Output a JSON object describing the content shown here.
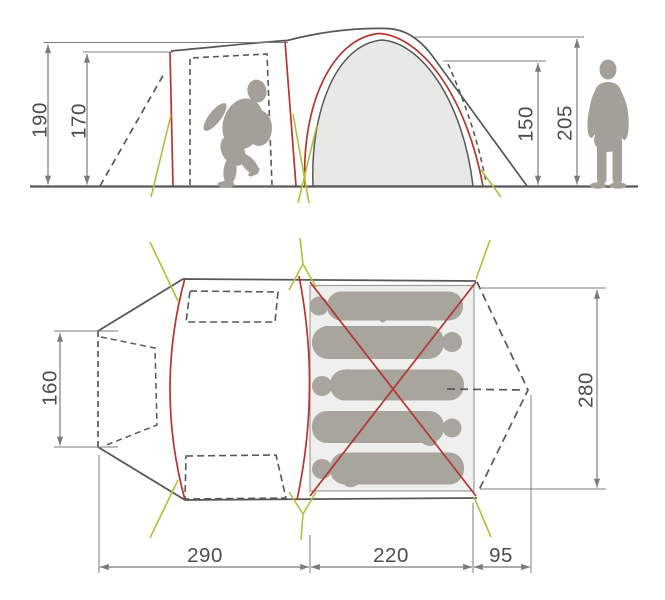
{
  "diagram": {
    "subject": "tent-dimension-diagram",
    "sleeping_spots": 5
  },
  "colors": {
    "outline_gray": "#57585a",
    "dimension_gray": "#7a7b7d",
    "text_gray": "#4c4d4f",
    "pole_red": "#b53530",
    "guyline_yellow": "#b3bf3a",
    "canvas_fill": "#e8e9e7",
    "floor_fill": "#eff0ee",
    "floor_border": "#9c9d9b",
    "silhouette_gray": "#a3a09a",
    "sleeper_gray": "#a8a49e"
  },
  "side_view": {
    "dimensions": {
      "front_height": {
        "label": "190"
      },
      "door_height": {
        "label": "170"
      },
      "inner_height": {
        "label": "150"
      },
      "peak_height": {
        "label": "205"
      }
    }
  },
  "top_view": {
    "dimensions": {
      "front_width": {
        "label": "160"
      },
      "inner_width": {
        "label": "280"
      },
      "tunnel_length": {
        "label": "290"
      },
      "inner_length": {
        "label": "220"
      },
      "rear_length": {
        "label": "95"
      }
    }
  }
}
